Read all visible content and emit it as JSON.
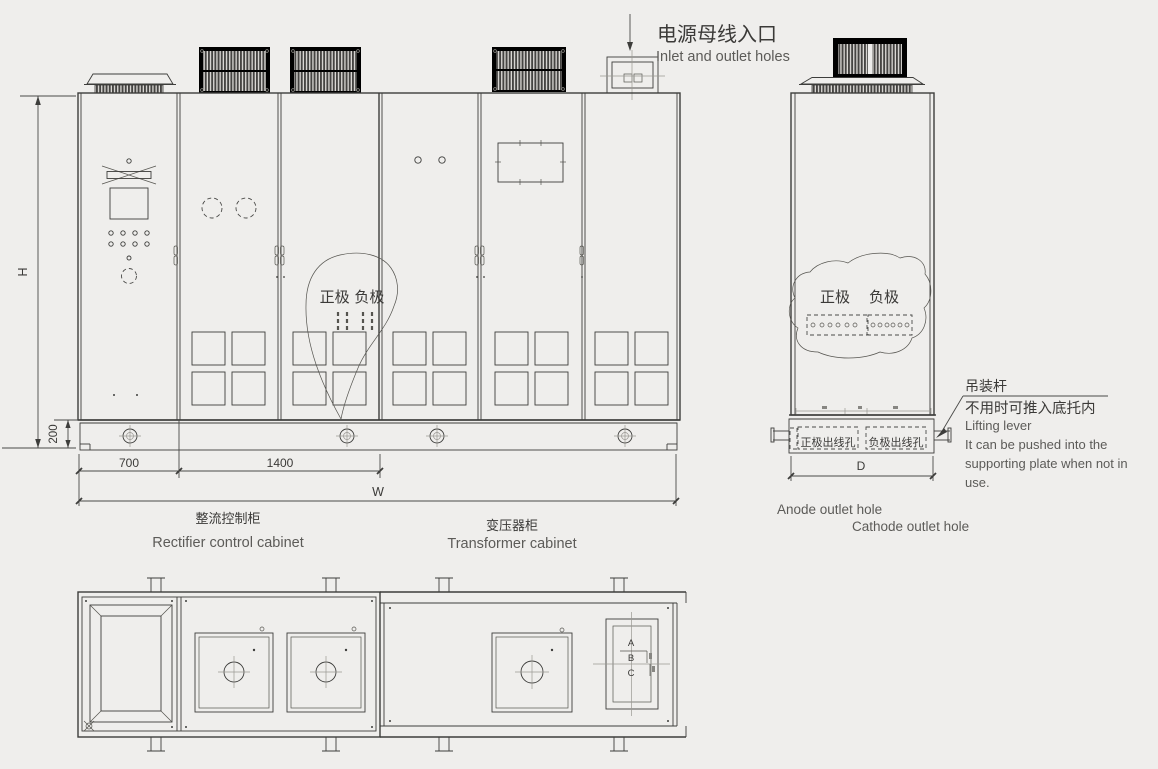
{
  "colors": {
    "background": "#efeeec",
    "line": "#3d3d3b",
    "text": "#3b3a38",
    "secondary_text": "#5c5b58",
    "hatch": "#454442"
  },
  "notes": {
    "power_inlet_zh": "电源母线入口",
    "power_inlet_en": "Inlet and outlet holes"
  },
  "front": {
    "polarity": "正极 负极",
    "dim_h": "H",
    "dim_base": "200",
    "dim_700": "700",
    "dim_1400": "1400",
    "dim_w": "W",
    "rectifier_zh": "整流控制柜",
    "rectifier_en": "Rectifier control cabinet",
    "transformer_zh": "变压器柜",
    "transformer_en": "Transformer cabinet"
  },
  "side": {
    "pos": "正极",
    "neg": "负极",
    "anode_zh": "正极出线孔",
    "cathode_zh": "负极出线孔",
    "dim_d": "D",
    "anode_en": "Anode outlet hole",
    "cathode_en": "Cathode outlet hole",
    "lift_zh1": "吊装杆",
    "lift_zh2": "不用时可推入底托内",
    "lift_en1": "Lifting lever",
    "lift_en2": "It can be pushed into the",
    "lift_en3": "supporting plate when not in",
    "lift_en4": "use."
  },
  "plan": {
    "a": "A",
    "b": "B",
    "c": "C"
  }
}
